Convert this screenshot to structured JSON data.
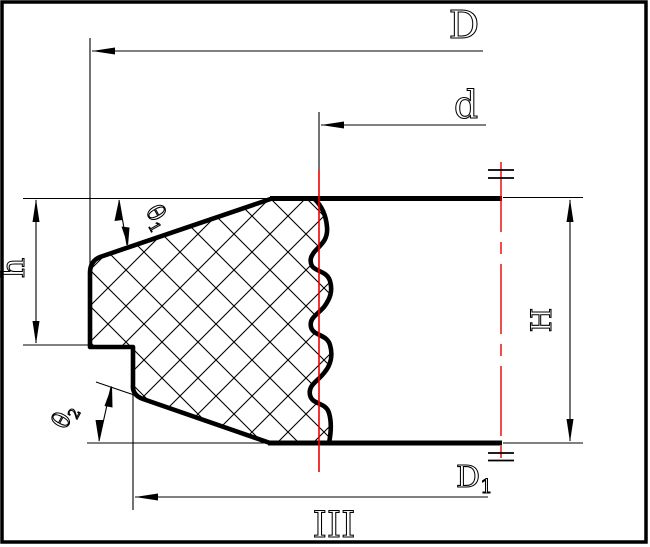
{
  "drawing": {
    "title_labels": {
      "outer_diameter": "D",
      "inner_diameter": "d",
      "step_height": "h",
      "total_height": "H",
      "bottom_diameter_main": "D",
      "bottom_diameter_sub": "1",
      "angle_top_main": "θ",
      "angle_top_sub": "1",
      "angle_bottom_main": "θ",
      "angle_bottom_sub": "2",
      "view_label": "III"
    },
    "icons": {
      "symmetry_mark": "double-bar-symmetry-mark",
      "dimension_arrow": "slender-filled-triangle"
    },
    "colors": {
      "line": "#000000",
      "highlight": "#ee0000",
      "background": "#ffffff"
    }
  }
}
